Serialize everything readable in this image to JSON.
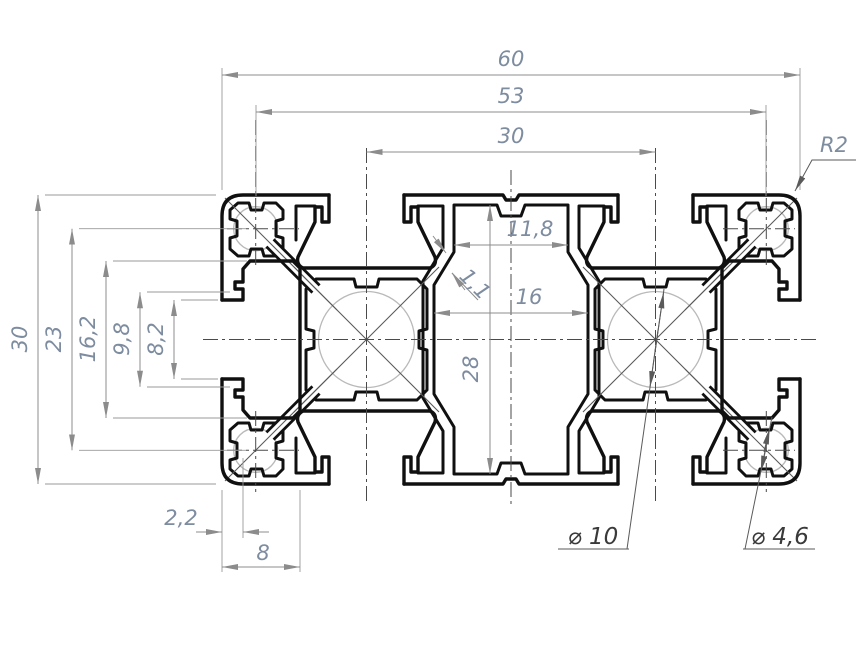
{
  "drawing": {
    "type": "aluminium-extrusion-profile-cross-section",
    "labels": {
      "overall_width": "60",
      "corner_channel_span": "53",
      "core_span": "30",
      "corner_radius": "R2",
      "cavity_top_width": "11,8",
      "wall_thickness": "1,1",
      "cavity_mid_width": "16",
      "cavity_height": "28",
      "overall_height": "30",
      "corner_channel_vspan": "23",
      "slot_cavity_height": "16,2",
      "slot_lip_height": "9,8",
      "slot_opening": "8,2",
      "lip_depth": "2,2",
      "slot_depth": "8",
      "core_hole_dia": "⌀ 10",
      "corner_hole_dia": "⌀ 4,6"
    },
    "colors": {
      "profile_line": "#101010",
      "dimension_line": "#8c8c8c",
      "dimension_text": "#7e8ca0",
      "leader_text": "#3a3a3a",
      "centerline": "#4a4a4a",
      "hidden_circle": "#b9b9b9",
      "background": "#ffffff"
    }
  }
}
